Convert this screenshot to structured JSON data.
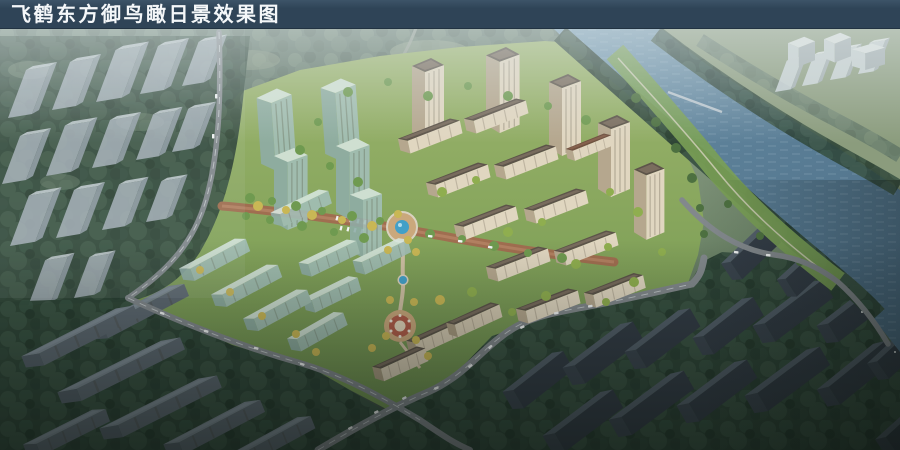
{
  "title_bar": {
    "title": "飞鹤东方御鸟瞰日景效果图"
  },
  "colors": {
    "bar": "#2f4457",
    "barTop": "#3d5468",
    "barText": "#f4f7f9",
    "water": "#5d8199",
    "waterDeep": "#4e6f87",
    "waterLight": "#7ba0b6",
    "forestDark": "#2e4537",
    "forestDark2": "#3a5343",
    "forestHaze": "#5f7567",
    "forestHaze2": "#6e8472",
    "meadow": "#8b9c7d",
    "lawn": "#86a55c",
    "lawnLight": "#9db56e",
    "treeBright": "#6f9a50",
    "treeLime": "#8fae4f",
    "treeYellow": "#c9b755",
    "treeDeep": "#4d7040",
    "road": "#82888c",
    "roadDash": "#e8ecee",
    "avenue": "#a06e50",
    "path": "#cfc0a4",
    "pond": "#43a0c8",
    "plazaRed": "#b05c49",
    "plazaTan": "#caa87c",
    "ghostWall": "#aab4bd",
    "ghostSide": "#97a2ac",
    "ghostTop": "#cdd5db",
    "paleWall": "#d6dee5",
    "paleTop": "#eef2f6",
    "beigeRoof": "#5d544a",
    "beigeRoofLight": "#7d7060",
    "beigeWallShade": "#b5a78e",
    "beigeWallLight": "#e0d6c0",
    "glassWall": "#a3bfb9",
    "glassSide": "#8fada8",
    "glassTop": "#d8e7e1",
    "darkWall": "#3b454f",
    "darkSide": "#333c46",
    "darkRoof": "#535f6a",
    "grayRowWall": "#535e67",
    "grayRowRoof": "#7b8791",
    "brownRoof": "#6f5140"
  }
}
